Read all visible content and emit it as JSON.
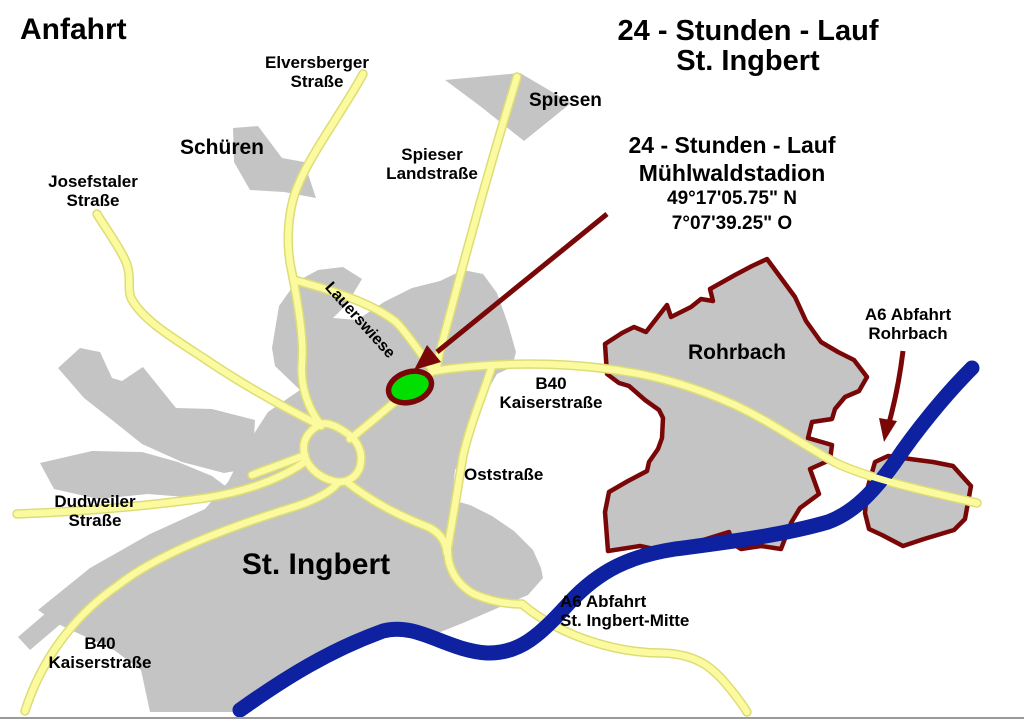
{
  "header": {
    "page_title": "Anfahrt",
    "event_title": "24 - Stunden - Lauf St. Ingbert"
  },
  "callout": {
    "line1": "24 - Stunden - Lauf",
    "line2": "Mühlwaldstadion",
    "lat": "49°17'05.75\" N",
    "lon": "7°07'39.25\" O"
  },
  "regions": {
    "st_ingbert": "St. Ingbert",
    "rohrbach": "Rohrbach",
    "schueren": "Schüren",
    "spiesen": "Spiesen"
  },
  "streets": {
    "elversberger": "Elversberger\nStraße",
    "josefstaler": "Josefstaler\nStraße",
    "spieser": "Spieser\nLandstraße",
    "lauerswiese": "Lauerswiese",
    "b40_kaiserstrasse_center": "B40\nKaiserstraße",
    "b40_kaiserstrasse_southwest": "B40\nKaiserstraße",
    "oststrasse": "Oststraße",
    "dudweiler": "Dudweiler\nStraße"
  },
  "highway": {
    "exit_rohrbach": "A6 Abfahrt\nRohrbach",
    "exit_st_ingbert_mitte": "A6 Abfahrt\nSt. Ingbert-Mitte"
  },
  "colors": {
    "background": "#ffffff",
    "region_fill": "#c4c4c4",
    "road_fill": "#fbfa9e",
    "road_casing": "#dddd77",
    "highway_a6_blue": "#0d21a1",
    "boundary_dark_red": "#7a0707",
    "stadium_green": "#00df00",
    "text": "#000000",
    "bottom_border": "#9a9a9a"
  }
}
